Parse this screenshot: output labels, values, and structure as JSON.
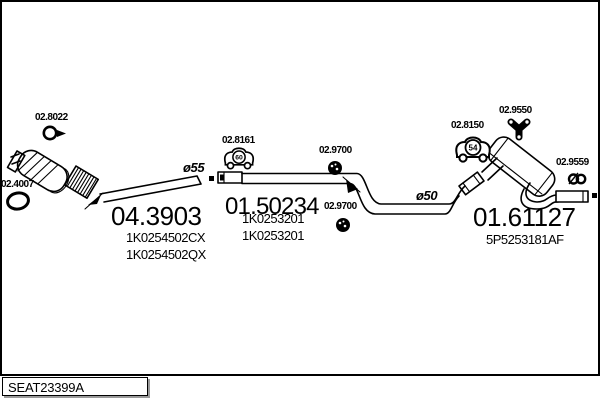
{
  "frame": {
    "sheet_code": "SEAT23399A"
  },
  "sections": [
    {
      "part_number": "04.3903",
      "oem_refs": [
        "1K0254502CX",
        "1K0254502QX"
      ]
    },
    {
      "part_number": "01.50234",
      "oem_refs": [
        "1K0253201",
        "1K0253201"
      ]
    },
    {
      "part_number": "01.61127",
      "oem_refs": [
        "5P5253181AF"
      ]
    }
  ],
  "small_parts": [
    {
      "code": "02.8022",
      "icon": "pipe-clamp-icon"
    },
    {
      "code": "02.4007",
      "icon": "gasket-ring-icon"
    },
    {
      "code": "02.8161",
      "icon": "rubber-hanger-icon",
      "badge": "60"
    },
    {
      "code": "02.9700",
      "icon": "grommet-icon"
    },
    {
      "code": "02.9700",
      "icon": "grommet-icon"
    },
    {
      "code": "02.8150",
      "icon": "rubber-hanger-icon",
      "badge": "54"
    },
    {
      "code": "02.9550",
      "icon": "triple-hanger-icon"
    },
    {
      "code": "02.9559",
      "icon": "pipe-clamp-icon"
    }
  ],
  "annotations": {
    "front_pipe_diameter": "ø55",
    "mid_pipe_diameter": "ø50"
  },
  "colors": {
    "line": "#000000",
    "background": "#ffffff",
    "shadow": "#9a9a9a"
  }
}
